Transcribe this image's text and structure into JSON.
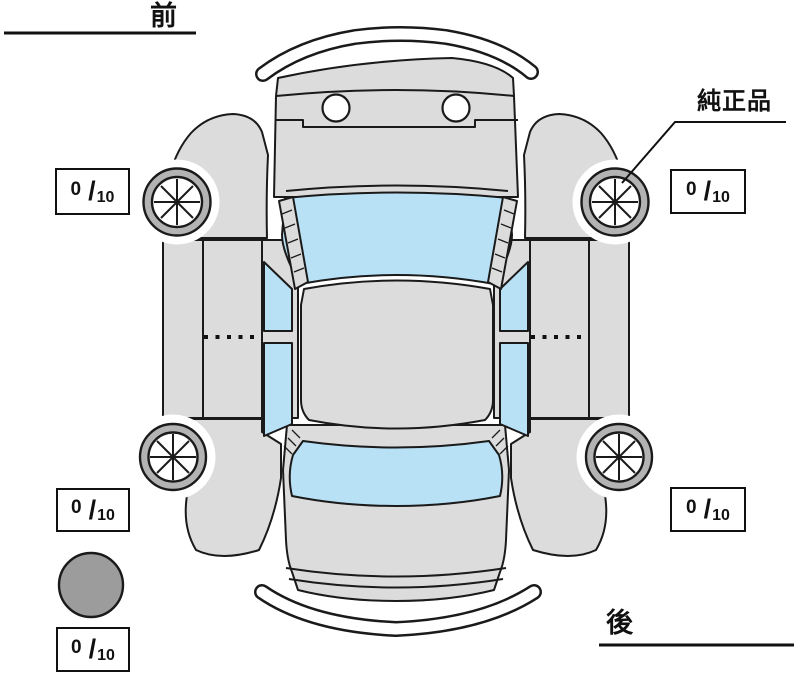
{
  "diagram": {
    "labels": {
      "front": "前",
      "rear": "後",
      "genuine_part": "純正品"
    },
    "tread": {
      "slash": "/",
      "denominator": "10",
      "front_left": {
        "value": "0"
      },
      "front_right": {
        "value": "0"
      },
      "rear_left": {
        "value": "0"
      },
      "rear_right": {
        "value": "0"
      },
      "spare": {
        "value": "0"
      }
    },
    "colors": {
      "body": "#dcdcdc",
      "glass": "#b9e1f5",
      "tire_ring": "#b3b3b3",
      "spare_tire": "#9c9c9c",
      "outline": "#1a1a1a",
      "background": "#ffffff"
    },
    "icons": {
      "wheel": "wheel-icon",
      "spare_tire": "spare-tire-icon"
    }
  }
}
